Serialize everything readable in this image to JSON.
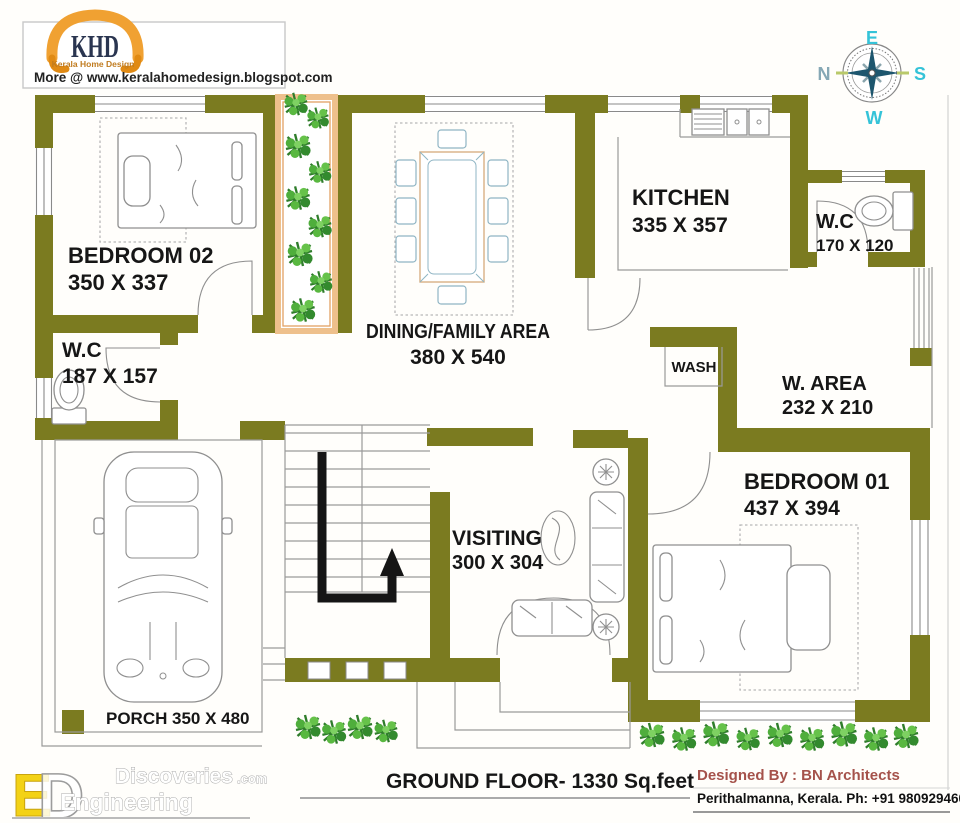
{
  "header": {
    "logo": {
      "abbr": "KHD",
      "name": "Kerala Home Design"
    },
    "website_line": "More @ www.keralahomedesign.blogspot.com"
  },
  "compass": {
    "top": "E",
    "left": "N",
    "right": "S",
    "bottom": "W"
  },
  "plan": {
    "rooms": [
      {
        "name": "BEDROOM 02",
        "size": "350 X 337"
      },
      {
        "name": "W.C",
        "size": "187 X 157"
      },
      {
        "name": "DINING/FAMILY AREA",
        "size": "380 X 540"
      },
      {
        "name": "KITCHEN",
        "size": "335 X 357"
      },
      {
        "name": "W.C",
        "size": "170 X 120"
      },
      {
        "name": "WASH",
        "size": ""
      },
      {
        "name": "W. AREA",
        "size": "232 X 210"
      },
      {
        "name": "BEDROOM 01",
        "size": "437 X 394"
      },
      {
        "name": "VISITING",
        "size": "300 X 304"
      },
      {
        "name": "PORCH",
        "size": "350 X 480"
      }
    ]
  },
  "footer": {
    "floor_title": "GROUND FLOOR- 1330 Sq.feet",
    "designed_by": "Designed By : BN Architects",
    "address": "Perithalmanna, Kerala. Ph: +91 9809294600"
  },
  "watermark": {
    "letter_e": "E",
    "letter_d": "D",
    "word_top": "Discoveries",
    "word_top_suffix": ".com",
    "word_bottom": "Engineering"
  },
  "colors": {
    "wall_olive": "#7b7b20",
    "logo_orange": "#f0a132",
    "compass_teal": "#35c3d8",
    "designer_red": "#a5524b",
    "plant_green": "#3f9c35",
    "courtyard_border": "#eec08c"
  }
}
